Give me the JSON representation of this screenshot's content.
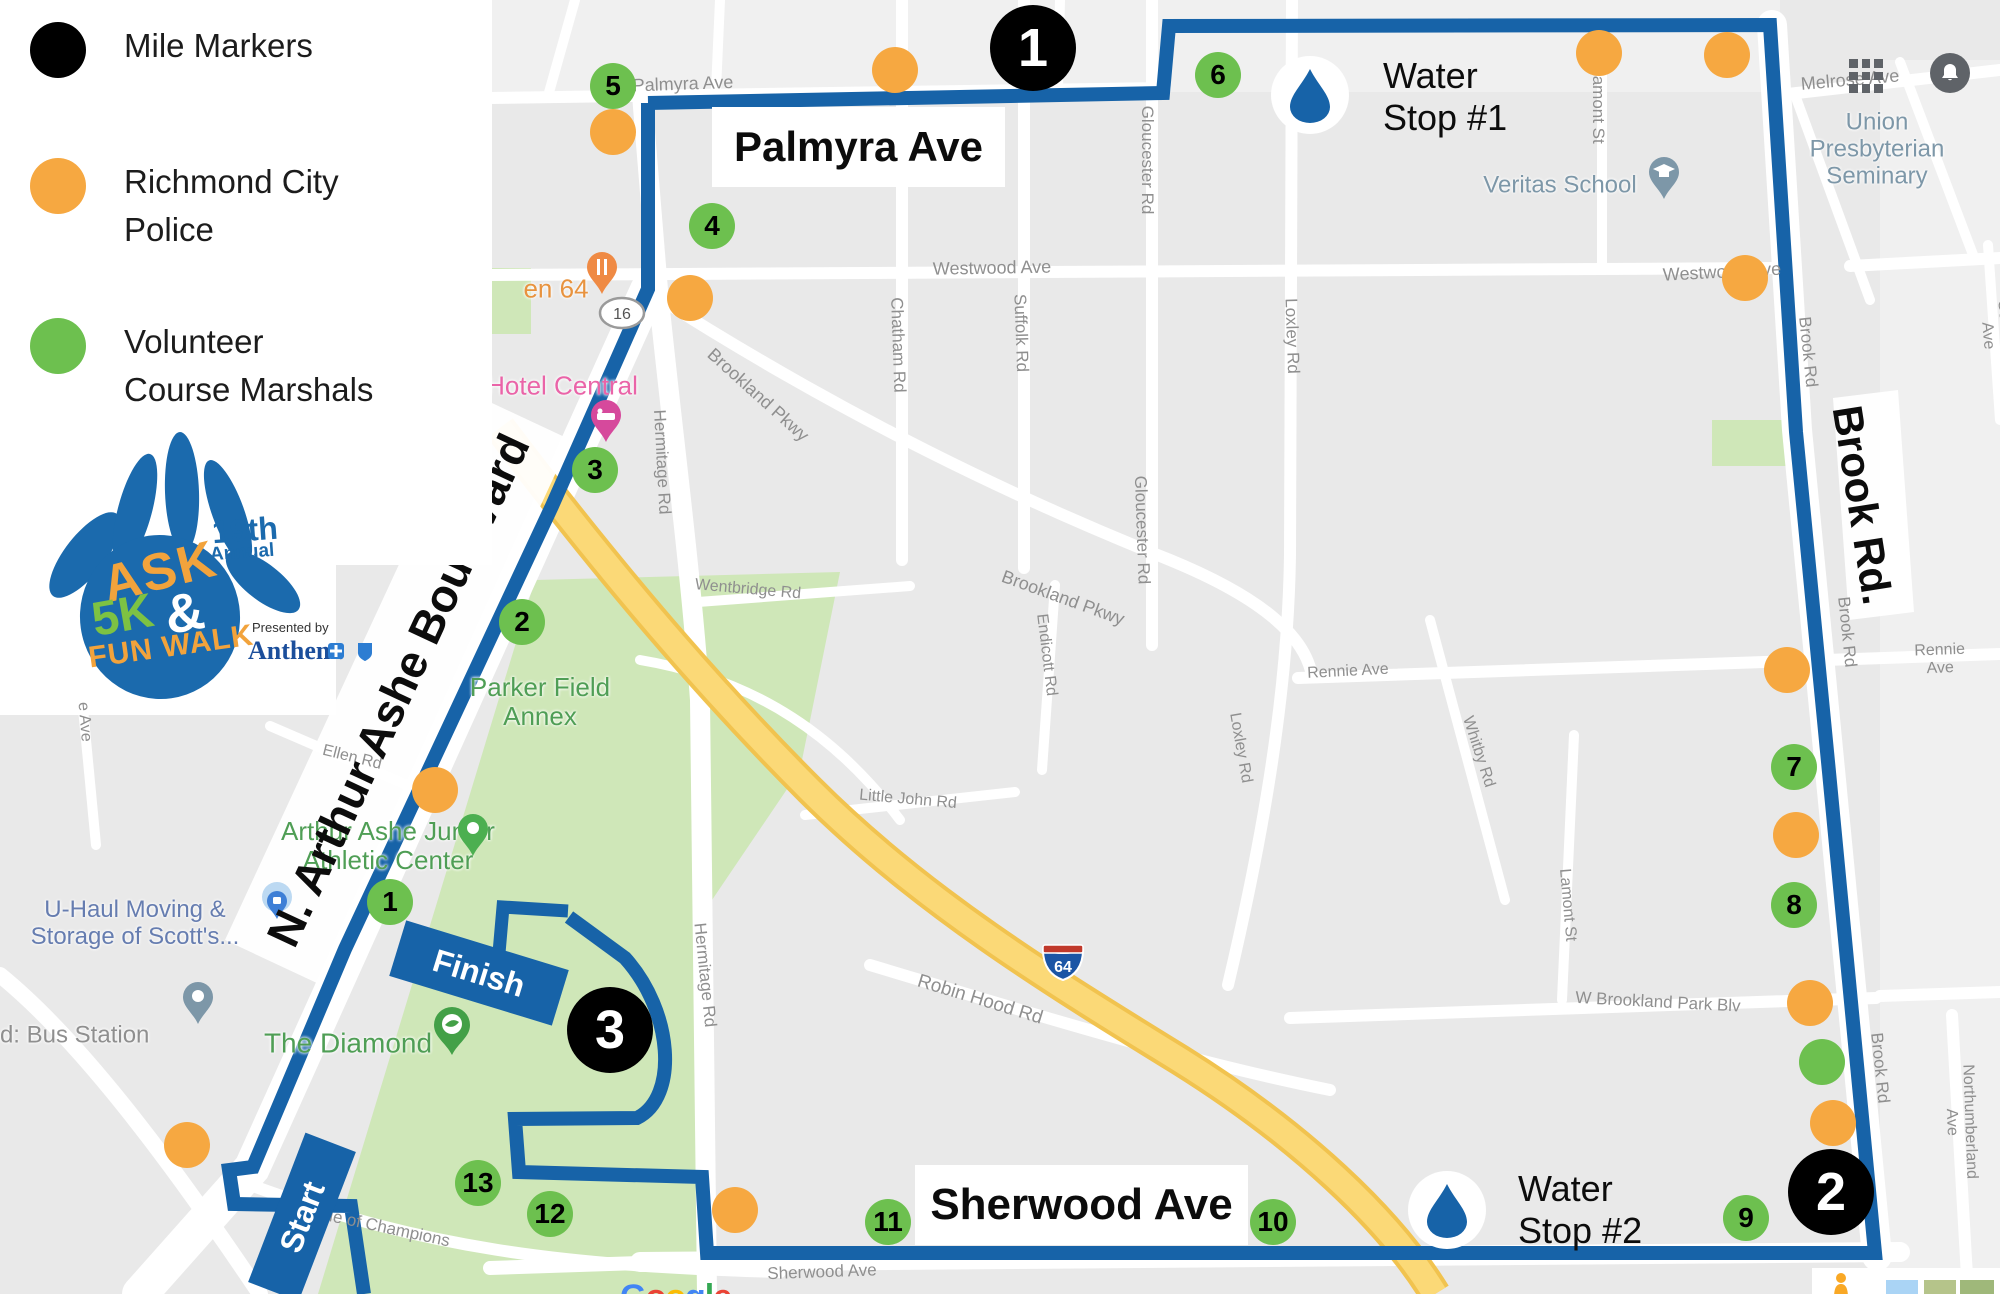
{
  "colors": {
    "route": "#1763a8",
    "police": "#f6a841",
    "marshal": "#6dc04f",
    "mile": "#000000",
    "street": "#8f8f8f",
    "poiGreen": "#4f9e55",
    "poiBlue": "#667db0",
    "poiSlate": "#7d97a8",
    "poiSlate2": "#8f8f8f",
    "poiPink": "#ea64a8",
    "poiOrange": "#e8933f",
    "parkGreen": "#cfe7b8",
    "highwayYellow": "#fbd977",
    "highwayCasing": "#f1c34f"
  },
  "legend": {
    "items": [
      {
        "label": "Mile Markers",
        "color": "#000000"
      },
      {
        "label": "Richmond City\nPolice",
        "color": "#f6a841"
      },
      {
        "label": "Volunteer\nCourse Marshals",
        "color": "#6dc04f"
      }
    ]
  },
  "logo": {
    "word1": "ASK",
    "word2": "5K",
    "amp": "&",
    "word3": "FUN WALK",
    "annual_line1": "19th",
    "annual_line2": "Annual",
    "presented_by": "Presented by",
    "sponsor": "Anthem."
  },
  "overlays": {
    "palmyra": "Palmyra Ave",
    "sherwood": "Sherwood Ave",
    "brook": "Brook Rd.",
    "ashe": "N. Arthur Ashe Boulevard"
  },
  "banners": {
    "start": "Start",
    "finish": "Finish"
  },
  "water_stops": [
    {
      "line1": "Water",
      "line2": "Stop #1",
      "x": 1310,
      "y": 95,
      "tx": 1383,
      "ty": 55
    },
    {
      "line1": "Water",
      "line2": "Stop #2",
      "x": 1447,
      "y": 1210,
      "tx": 1518,
      "ty": 1168
    }
  ],
  "shields": {
    "interstate": "64",
    "state_route": "16"
  },
  "google": {
    "letters": [
      [
        "G",
        "#4285F4"
      ],
      [
        "o",
        "#EA4335"
      ],
      [
        "o",
        "#FBBC05"
      ],
      [
        "g",
        "#4285F4"
      ],
      [
        "l",
        "#34A853"
      ],
      [
        "e",
        "#EA4335"
      ]
    ]
  },
  "markers": {
    "mile": [
      {
        "n": "1",
        "x": 1033,
        "y": 48
      },
      {
        "n": "2",
        "x": 1831,
        "y": 1192
      },
      {
        "n": "3",
        "x": 610,
        "y": 1030
      }
    ],
    "marshal": [
      {
        "n": "1",
        "x": 390,
        "y": 902
      },
      {
        "n": "2",
        "x": 522,
        "y": 622
      },
      {
        "n": "3",
        "x": 595,
        "y": 470
      },
      {
        "n": "4",
        "x": 712,
        "y": 226
      },
      {
        "n": "5",
        "x": 613,
        "y": 86
      },
      {
        "n": "6",
        "x": 1218,
        "y": 75
      },
      {
        "n": "7",
        "x": 1794,
        "y": 767
      },
      {
        "n": "8",
        "x": 1794,
        "y": 905
      },
      {
        "n": "9",
        "x": 1746,
        "y": 1218
      },
      {
        "n": "10",
        "x": 1273,
        "y": 1222
      },
      {
        "n": "11",
        "x": 888,
        "y": 1222
      },
      {
        "n": "12",
        "x": 550,
        "y": 1214
      },
      {
        "n": "13",
        "x": 478,
        "y": 1183
      },
      {
        "n": "",
        "x": 1822,
        "y": 1062
      }
    ],
    "police": [
      [
        613,
        132
      ],
      [
        690,
        298
      ],
      [
        895,
        70
      ],
      [
        1599,
        53
      ],
      [
        1727,
        55
      ],
      [
        1745,
        278
      ],
      [
        1787,
        670
      ],
      [
        1796,
        835
      ],
      [
        1810,
        1003
      ],
      [
        1833,
        1123
      ],
      [
        435,
        790
      ],
      [
        187,
        1145
      ],
      [
        735,
        1210
      ]
    ]
  },
  "map_labels": [
    {
      "t": "Palmyra Ave",
      "x": 683,
      "y": 84,
      "r": -2,
      "s": 18
    },
    {
      "t": "Gloucester Rd",
      "x": 1147,
      "y": 160,
      "r": 90,
      "s": 17
    },
    {
      "t": "Lamont St",
      "x": 1598,
      "y": 105,
      "r": 90,
      "s": 17
    },
    {
      "t": "Melrose Ave",
      "x": 1850,
      "y": 80,
      "r": -5,
      "s": 18
    },
    {
      "t": "Westwood Ave",
      "x": 992,
      "y": 268,
      "r": -1,
      "s": 18
    },
    {
      "t": "Westwood Ave",
      "x": 1722,
      "y": 272,
      "r": -3,
      "s": 18
    },
    {
      "t": "Chatham Rd",
      "x": 898,
      "y": 345,
      "r": 88,
      "s": 17
    },
    {
      "t": "Suffolk Rd",
      "x": 1021,
      "y": 333,
      "r": 88,
      "s": 17
    },
    {
      "t": "Loxley Rd",
      "x": 1292,
      "y": 336,
      "r": 88,
      "s": 17
    },
    {
      "t": "Gloucester Rd",
      "x": 1142,
      "y": 530,
      "r": 88,
      "s": 17
    },
    {
      "t": "Brookland Pkwy",
      "x": 758,
      "y": 395,
      "r": 42,
      "s": 18
    },
    {
      "t": "Brookland Pkwy",
      "x": 1063,
      "y": 598,
      "r": 20,
      "s": 18
    },
    {
      "t": "Wentbridge Rd",
      "x": 748,
      "y": 590,
      "r": 5,
      "s": 16
    },
    {
      "t": "Endicott Rd",
      "x": 1046,
      "y": 655,
      "r": 83,
      "s": 16
    },
    {
      "t": "Loxley Rd",
      "x": 1240,
      "y": 748,
      "r": 80,
      "s": 16
    },
    {
      "t": "Rennie Ave",
      "x": 1348,
      "y": 672,
      "r": -3,
      "s": 16
    },
    {
      "t": "Rennie Ave",
      "x": 1940,
      "y": 660,
      "r": -2,
      "s": 16
    },
    {
      "t": "Whitby Rd",
      "x": 1478,
      "y": 752,
      "r": 72,
      "s": 16
    },
    {
      "t": "Lamont St",
      "x": 1567,
      "y": 905,
      "r": 85,
      "s": 16
    },
    {
      "t": "Little John Rd",
      "x": 908,
      "y": 800,
      "r": 5,
      "s": 16
    },
    {
      "t": "Robin Hood Rd",
      "x": 980,
      "y": 1000,
      "r": 17,
      "s": 19
    },
    {
      "t": "Hermitage Rd",
      "x": 662,
      "y": 462,
      "r": 87,
      "s": 17
    },
    {
      "t": "Hermitage Rd",
      "x": 705,
      "y": 975,
      "r": 84,
      "s": 17
    },
    {
      "t": "Brook Rd",
      "x": 1808,
      "y": 352,
      "r": 84,
      "s": 17
    },
    {
      "t": "Brook Rd",
      "x": 1847,
      "y": 632,
      "r": 84,
      "s": 17
    },
    {
      "t": "Brook Rd",
      "x": 1880,
      "y": 1068,
      "r": 84,
      "s": 17
    },
    {
      "t": "Northumberland Ave",
      "x": 1960,
      "y": 1122,
      "r": 88,
      "s": 16
    },
    {
      "t": "Seminary Ave",
      "x": 1996,
      "y": 335,
      "r": 85,
      "s": 16
    },
    {
      "t": "Sherwood Ave",
      "x": 822,
      "y": 1272,
      "r": -2,
      "s": 17
    },
    {
      "t": "Ellen Rd",
      "x": 352,
      "y": 758,
      "r": 14,
      "s": 16
    },
    {
      "t": "e Ave",
      "x": 84,
      "y": 722,
      "r": 85,
      "s": 16
    },
    {
      "t": "Avenue of Champions",
      "x": 368,
      "y": 1224,
      "r": 12,
      "s": 17
    },
    {
      "t": "W Brookland Park Blv",
      "x": 1658,
      "y": 1002,
      "r": 3,
      "s": 17
    }
  ],
  "pois": [
    {
      "t": "en 64",
      "x": 556,
      "y": 289,
      "s": 26,
      "k": "poiOrange",
      "icon": "restaurant-pin",
      "ix": 602,
      "iy": 300
    },
    {
      "t": "Hotel Central",
      "x": 562,
      "y": 386,
      "s": 26,
      "k": "poiPink",
      "icon": "hotel-pin",
      "ix": 606,
      "iy": 448
    },
    {
      "t": "Veritas School",
      "x": 1560,
      "y": 186,
      "s": 24,
      "k": "poiSlate",
      "icon": "school-pin",
      "ix": 1664,
      "iy": 205
    },
    {
      "t": "Union Presbyterian\nSeminary",
      "x": 1877,
      "y": 150,
      "s": 24,
      "k": "poiSlate"
    },
    {
      "t": "Parker Field\nAnnex",
      "x": 540,
      "y": 702,
      "s": 26,
      "k": "poiGreen"
    },
    {
      "t": "Arthur Ashe Junior\nAthletic Center",
      "x": 388,
      "y": 846,
      "s": 26,
      "k": "poiGreen",
      "icon": "athletic-pin",
      "ix": 473,
      "iy": 862
    },
    {
      "t": "The Diamond",
      "x": 348,
      "y": 1043,
      "s": 28,
      "k": "poiGreen",
      "icon": "diamond-pin",
      "ix": 452,
      "iy": 1060
    },
    {
      "t": "U-Haul Moving &\nStorage of Scott's...",
      "x": 135,
      "y": 924,
      "s": 24,
      "k": "poiBlue",
      "icon": "uhaul-pin",
      "ix": 277,
      "iy": 938
    },
    {
      "t": "nd: Bus Station",
      "x": 68,
      "y": 1036,
      "s": 24,
      "k": "poiSlate2",
      "icon": "bus-pin",
      "ix": 198,
      "iy": 1030
    }
  ]
}
